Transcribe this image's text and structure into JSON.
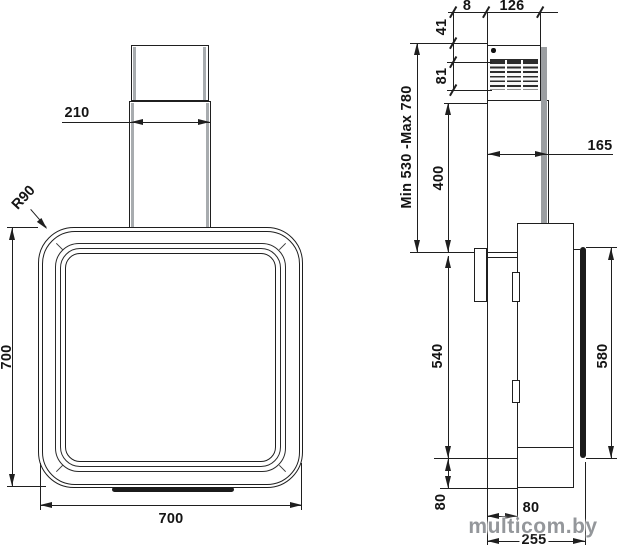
{
  "front_view": {
    "dims": {
      "chimney_width": "210",
      "corner_radius": "R90",
      "body_height": "700",
      "body_width": "700"
    }
  },
  "side_view": {
    "dims": {
      "wall_gap": "8",
      "chimney_depth": "126",
      "grille_top_offset": "41",
      "grille_height": "81",
      "chimney_height_range": "Min 530 -Max 780",
      "lower_chimney_height": "400",
      "chimney_front_depth": "165",
      "body_height": "540",
      "front_panel_height": "580",
      "bottom_section_height": "80",
      "back_depth": "80",
      "total_depth": "255"
    }
  },
  "watermark": {
    "text": "multicom.by"
  }
}
